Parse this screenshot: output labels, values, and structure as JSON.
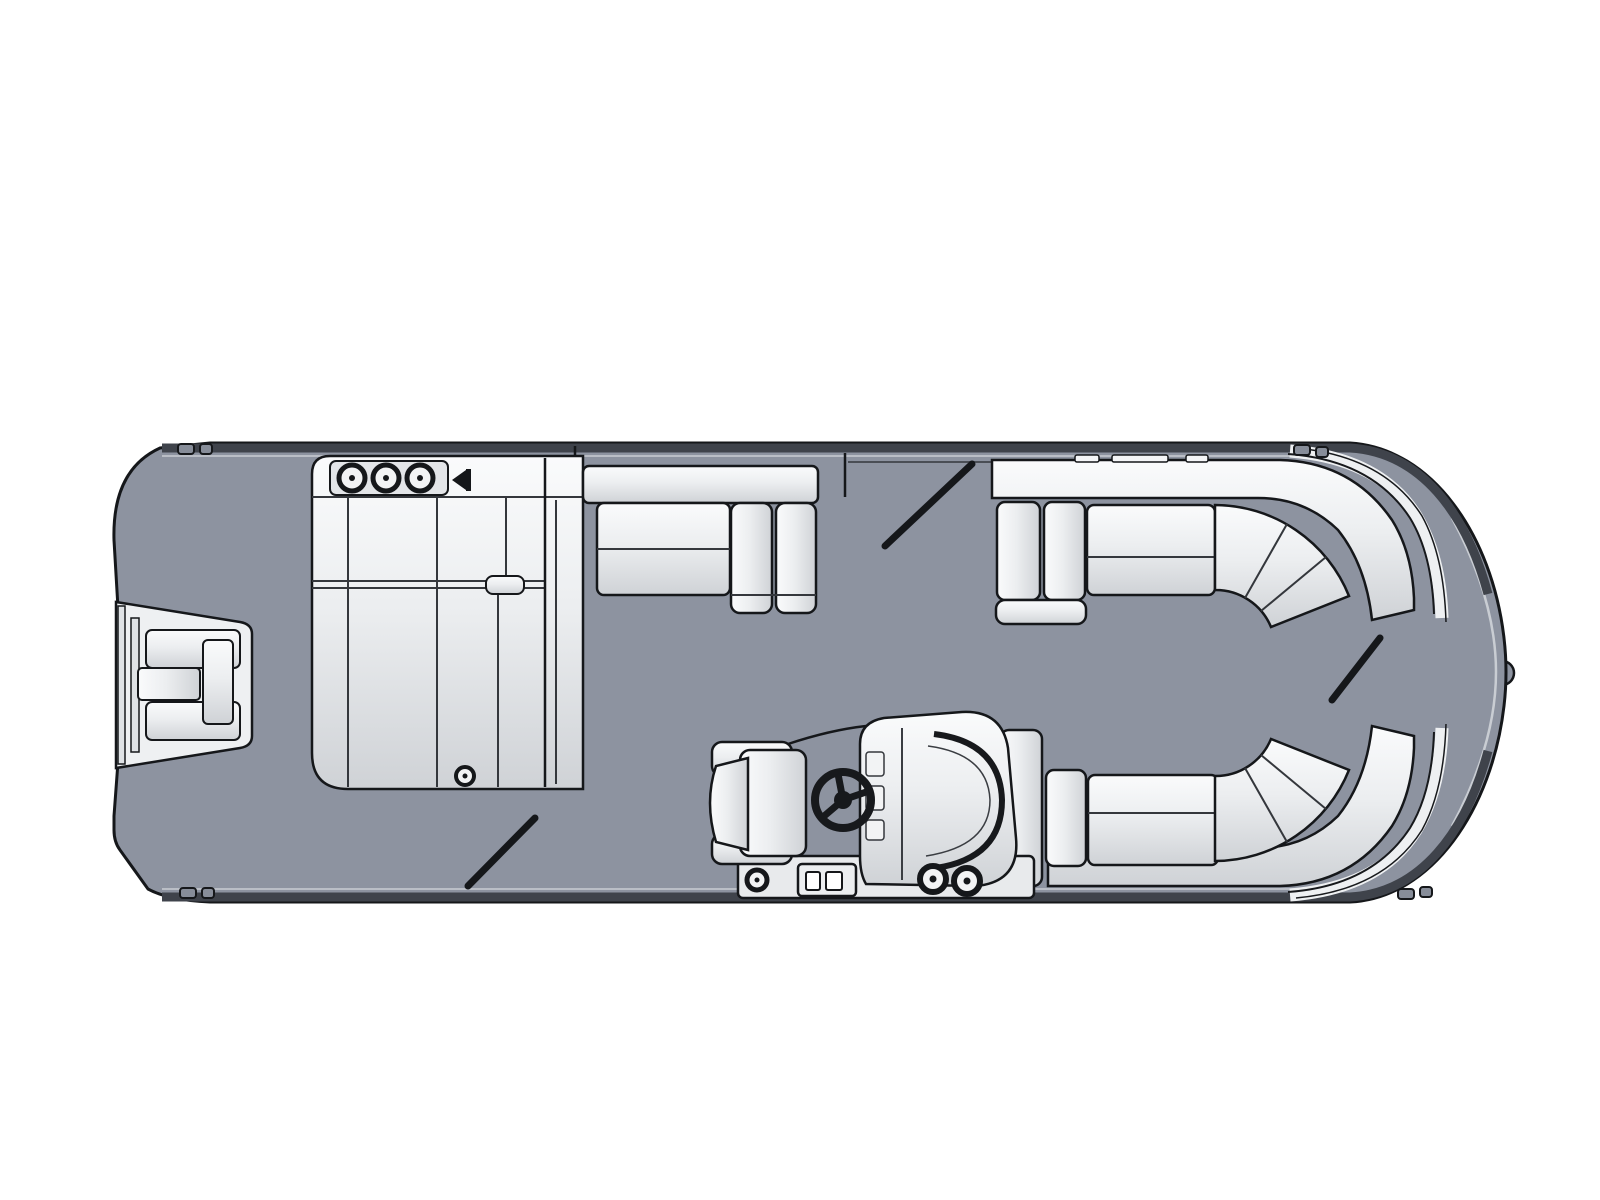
{
  "meta": {
    "diagram_type": "pontoon boat floor plan, top view line drawing",
    "orientation": {
      "bow": "right",
      "stern": "left"
    }
  },
  "colors": {
    "background": "#ffffff",
    "deck": "#8d93a0",
    "rail_dark": "#3f434b",
    "rail_light": "#c9cdd3",
    "outline": "#15171a",
    "upholstery_light": "#fafbfc",
    "upholstery_shade": "#cfd3d7",
    "panel": "#e3e5e8",
    "wheel": "#17191c"
  },
  "parts": {
    "hull": "pontoon deck outline",
    "swim_platform": "stern swim platform",
    "motor_pod": "outboard motor well at stern",
    "stern_lounger": "port-side stern lounge group with chaise",
    "stern_speaker_count": 3,
    "mid_bench": "midship bench with backrest and end cushions",
    "side_gate_top": "starboard side gate (open)",
    "side_gate_bottom": "port side gate (open)",
    "bow_gate": "bow boarding gate (open)",
    "bow_couch_starboard": "starboard bow wraparound couch",
    "bow_couch_port": "port bow wraparound couch",
    "helm_console": "helm console with windshield",
    "captains_chair": "captain's chair",
    "steering_wheel": "steering wheel",
    "helm_speaker_count": 2,
    "cleat_count": 4,
    "nav_light": "bow navigation light"
  }
}
